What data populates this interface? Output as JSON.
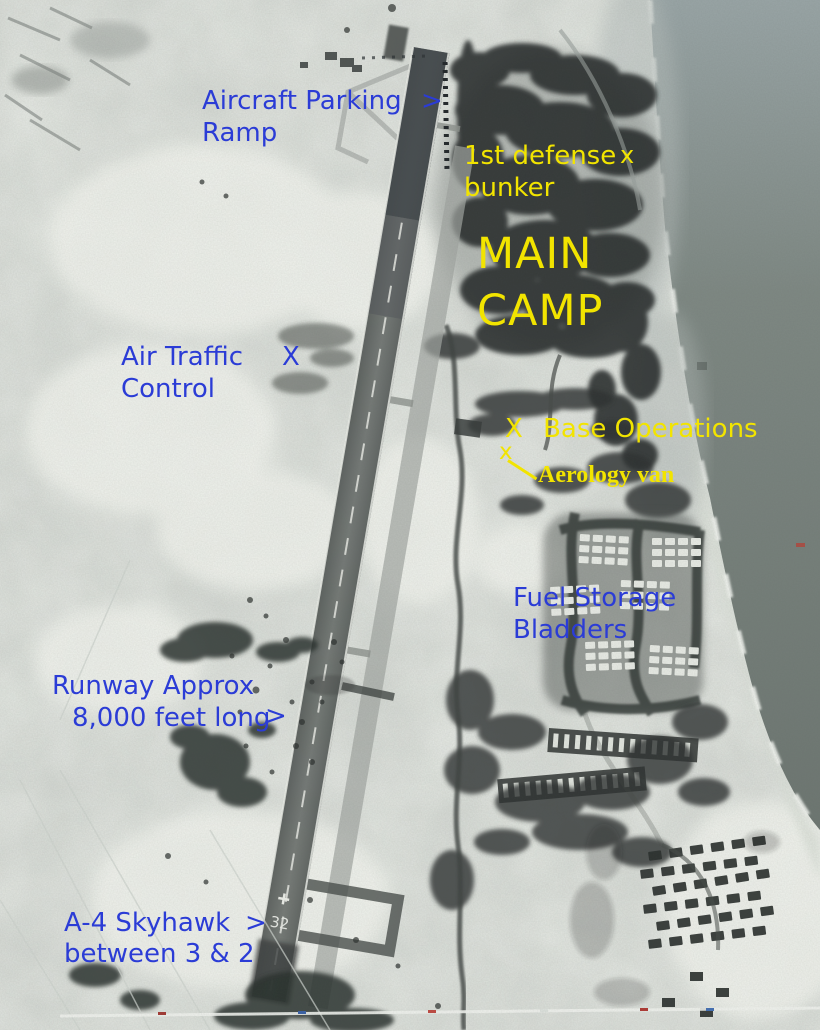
{
  "photo": {
    "runway_number": "32"
  },
  "colors": {
    "annotation_blue": "#2b3cd6",
    "annotation_yellow": "#f2e400"
  },
  "annotations": {
    "aircraft_parking": {
      "line1": "Aircraft Parking",
      "line2": "Ramp",
      "arrow": ">"
    },
    "defense_bunker": {
      "line1": "1st defense",
      "marker": "x",
      "line2": "bunker"
    },
    "main_camp": {
      "line1": "MAIN",
      "line2": "CAMP"
    },
    "air_traffic_control": {
      "line1": "Air Traffic",
      "line2": "Control",
      "marker": "X"
    },
    "base_operations": {
      "marker": "X",
      "label": "Base Operations"
    },
    "aerology_van": {
      "marker": "x",
      "label": "Aerology van"
    },
    "fuel_storage": {
      "line1": "Fuel Storage",
      "line2": "Bladders"
    },
    "runway_length": {
      "line1": "Runway Approx",
      "line2": "8,000 feet long",
      "arrow": ">"
    },
    "a4_skyhawk": {
      "line1": "A-4 Skyhawk",
      "arrow": ">",
      "line2": "between 3 & 2"
    }
  }
}
